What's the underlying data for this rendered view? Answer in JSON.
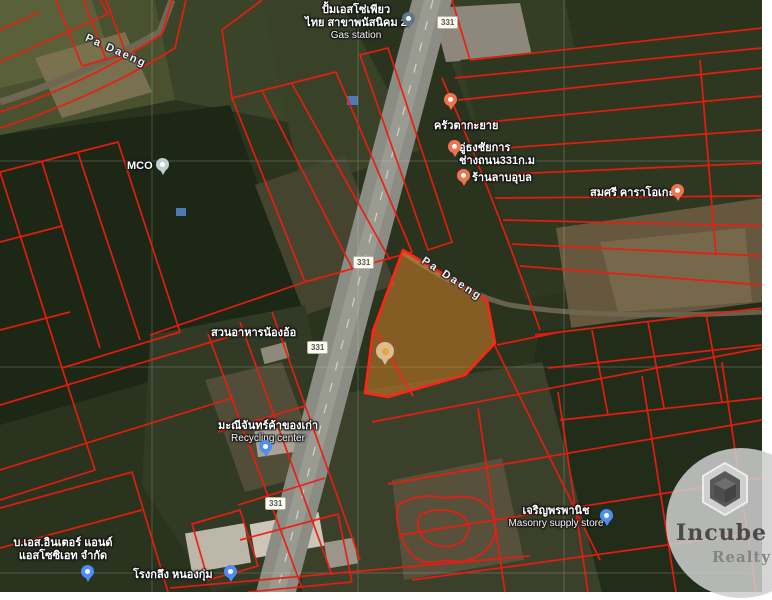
{
  "watermark": {
    "brand": "Incube",
    "sub": "Realty"
  },
  "road_shields": [
    {
      "label": "331"
    },
    {
      "label": "331"
    },
    {
      "label": "331"
    },
    {
      "label": "331"
    }
  ],
  "road_labels": [
    {
      "text": "Pa Daeng"
    },
    {
      "text": "Pa Daeng"
    }
  ],
  "places": [
    {
      "line1": "ปั้มเอสโซ่เพียว",
      "line2": "ไทย สาขาพนัสนิคม 2",
      "sub": "Gas station",
      "pin": "gas-station"
    },
    {
      "line1": "ครัวตากะยาย",
      "pin": "restaurant"
    },
    {
      "line1": "อู่ธงชัยการ",
      "line2": "ช่างถนน331ก.ม",
      "pin": "auto-shop"
    },
    {
      "line1": "ร้านลาบอุบล",
      "pin": "restaurant"
    },
    {
      "line1": "สมศรี คาราโอเกะ",
      "pin": "karaoke"
    },
    {
      "line1": "MCO",
      "pin": "generic"
    },
    {
      "line1": "สวนอาหารน้องอ้อ"
    },
    {
      "line1": "มะณีจันทร์ค้าของเก่า",
      "sub": "Recycling center",
      "pin": "store"
    },
    {
      "line1": "เจริญพรพานิช",
      "sub": "Masonry supply store",
      "pin": "store"
    },
    {
      "line1": "บ.เอส.อินเตอร์ แอนด์",
      "line2": "แอสโซซิเอท จำกัด",
      "pin": "store"
    },
    {
      "line1": "โรงกลึง หนองกุ่ม",
      "pin": "store"
    }
  ],
  "colors": {
    "cadastral_line": "#EF1B10",
    "highlight_parcel_fill": "#D9822B",
    "highlight_parcel_border": "#FF2415",
    "road_fill": "#8B8C83",
    "pin_orange": "#EE7450",
    "pin_blue": "#4E8DF2",
    "pin_gas": "#5D7587",
    "pin_gray": "#C3CDD4",
    "property_pin": "#ECC9A3",
    "shield_bg": "#FDFDF6"
  }
}
